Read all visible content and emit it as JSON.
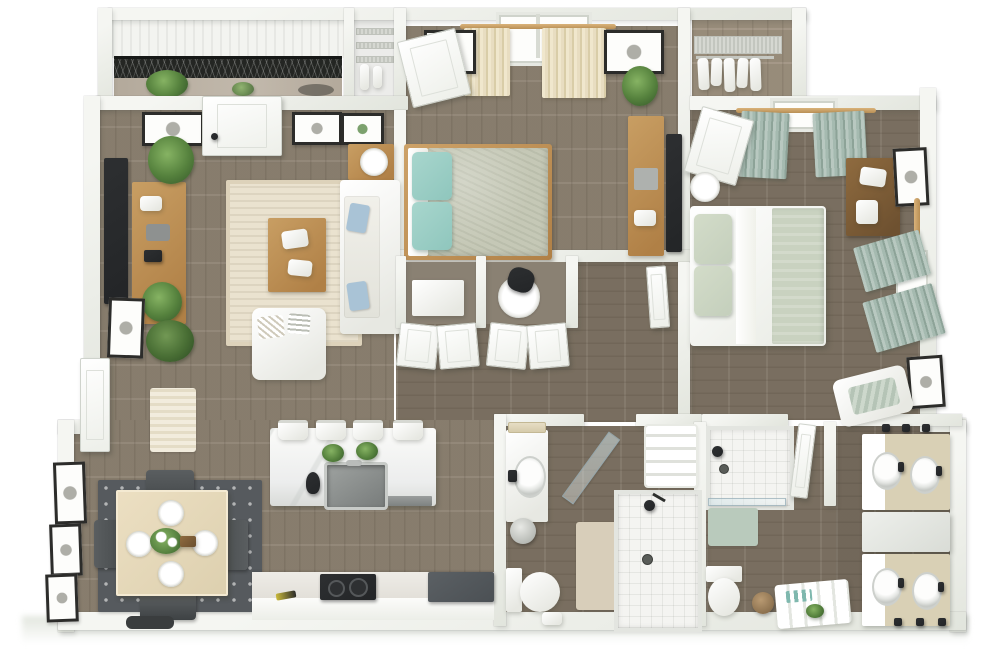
{
  "meta": {
    "description": "3D rendered top-down floor plan of a two-bedroom, two-bathroom apartment with balcony, no text labels visible",
    "render_style": "photoreal isometric dollhouse view, white walls, gray-brown hardwood floors"
  },
  "palette": {
    "wall": "#f5f6f2",
    "wall2": "#e2e5dd",
    "floor": "#8d8272",
    "floor-dark": "#7e7364",
    "concrete": "#b3a99b",
    "railing": "#242623",
    "rug-cream": "#eae2cf",
    "rug-dark": "#565a5e",
    "teal": "#8fc6bd",
    "sage": "#a5bab0",
    "sage-light": "#c4cfbc",
    "curtain-cream": "#e8ddc1",
    "wood-light": "#c89e63",
    "wood-dark": "#8f6b3f",
    "counter-tan": "#d9d0b5",
    "dark": "#232527",
    "appliance": "#4b5054",
    "mat-beige": "#d8ceba",
    "mat-sage": "#b9cabc",
    "plant": "#3f6530",
    "pillow-blue": "#a9c3d6"
  },
  "scene": {
    "type": "3d-floor-plan",
    "rooms": [
      {
        "id": "balcony",
        "features": [
          "black-mesh-railing",
          "potted-plants",
          "concrete-floor"
        ]
      },
      {
        "id": "laundry-closet",
        "features": [
          "wire-shelving",
          "hanging-items"
        ]
      },
      {
        "id": "living-room",
        "furniture": [
          "wall-mounted-tv",
          "wood-media-console",
          "fiddle-leaf-plants",
          "cream-area-rug",
          "wood-coffee-table-with-books",
          "white-sofa-blue-pillows",
          "white-accent-armchair",
          "side-table-with-lamp",
          "balcony-door",
          "framed-wall-art"
        ]
      },
      {
        "id": "bedroom-1",
        "furniture": [
          "bed-teal-pillows-sage-comforter",
          "cream-curtained-window",
          "framed-art",
          "dresser",
          "wall-tv",
          "potted-plant",
          "entry-door"
        ]
      },
      {
        "id": "walk-in-closet",
        "features": [
          "wire-shelf",
          "hanging-clothes"
        ]
      },
      {
        "id": "bedroom-2",
        "furniture": [
          "bed-white-duvet-sage-pillows",
          "sage-curtained-windows",
          "walnut-dresser",
          "framed-art",
          "round-side-table",
          "chaise-lounge",
          "entry-door"
        ]
      },
      {
        "id": "hallway",
        "features": [
          "double-door-closets",
          "built-in-desk-nook",
          "office-chair",
          "doors"
        ]
      },
      {
        "id": "dining-area",
        "furniture": [
          "square-dining-table",
          "four-place-settings",
          "floral-centerpiece",
          "four-gray-chairs",
          "patterned-dark-rug",
          "gallery-wall-frames",
          "entry-door",
          "door-mat"
        ]
      },
      {
        "id": "kitchen",
        "furniture": [
          "marble-island",
          "undermount-sink",
          "black-faucet",
          "island-plants",
          "four-bar-stools",
          "dishwasher",
          "cooktop",
          "wall-oven",
          "counter-run"
        ]
      },
      {
        "id": "bathroom-1",
        "furniture": [
          "vanity-with-sink",
          "towel-bar",
          "towel-basket",
          "toilet",
          "beige-bath-mat",
          "walk-in-shower",
          "glass-door",
          "linen-shelves",
          "step-stool"
        ]
      },
      {
        "id": "bathroom-2",
        "furniture": [
          "walk-in-shower",
          "sage-bath-mat",
          "toilet",
          "wicker-basket",
          "storage-cart-with-towels",
          "entry-door"
        ]
      },
      {
        "id": "vanity-room",
        "furniture": [
          "double-vanity-north",
          "storage-cabinet",
          "double-vanity-south",
          "towel-hooks"
        ]
      }
    ]
  }
}
